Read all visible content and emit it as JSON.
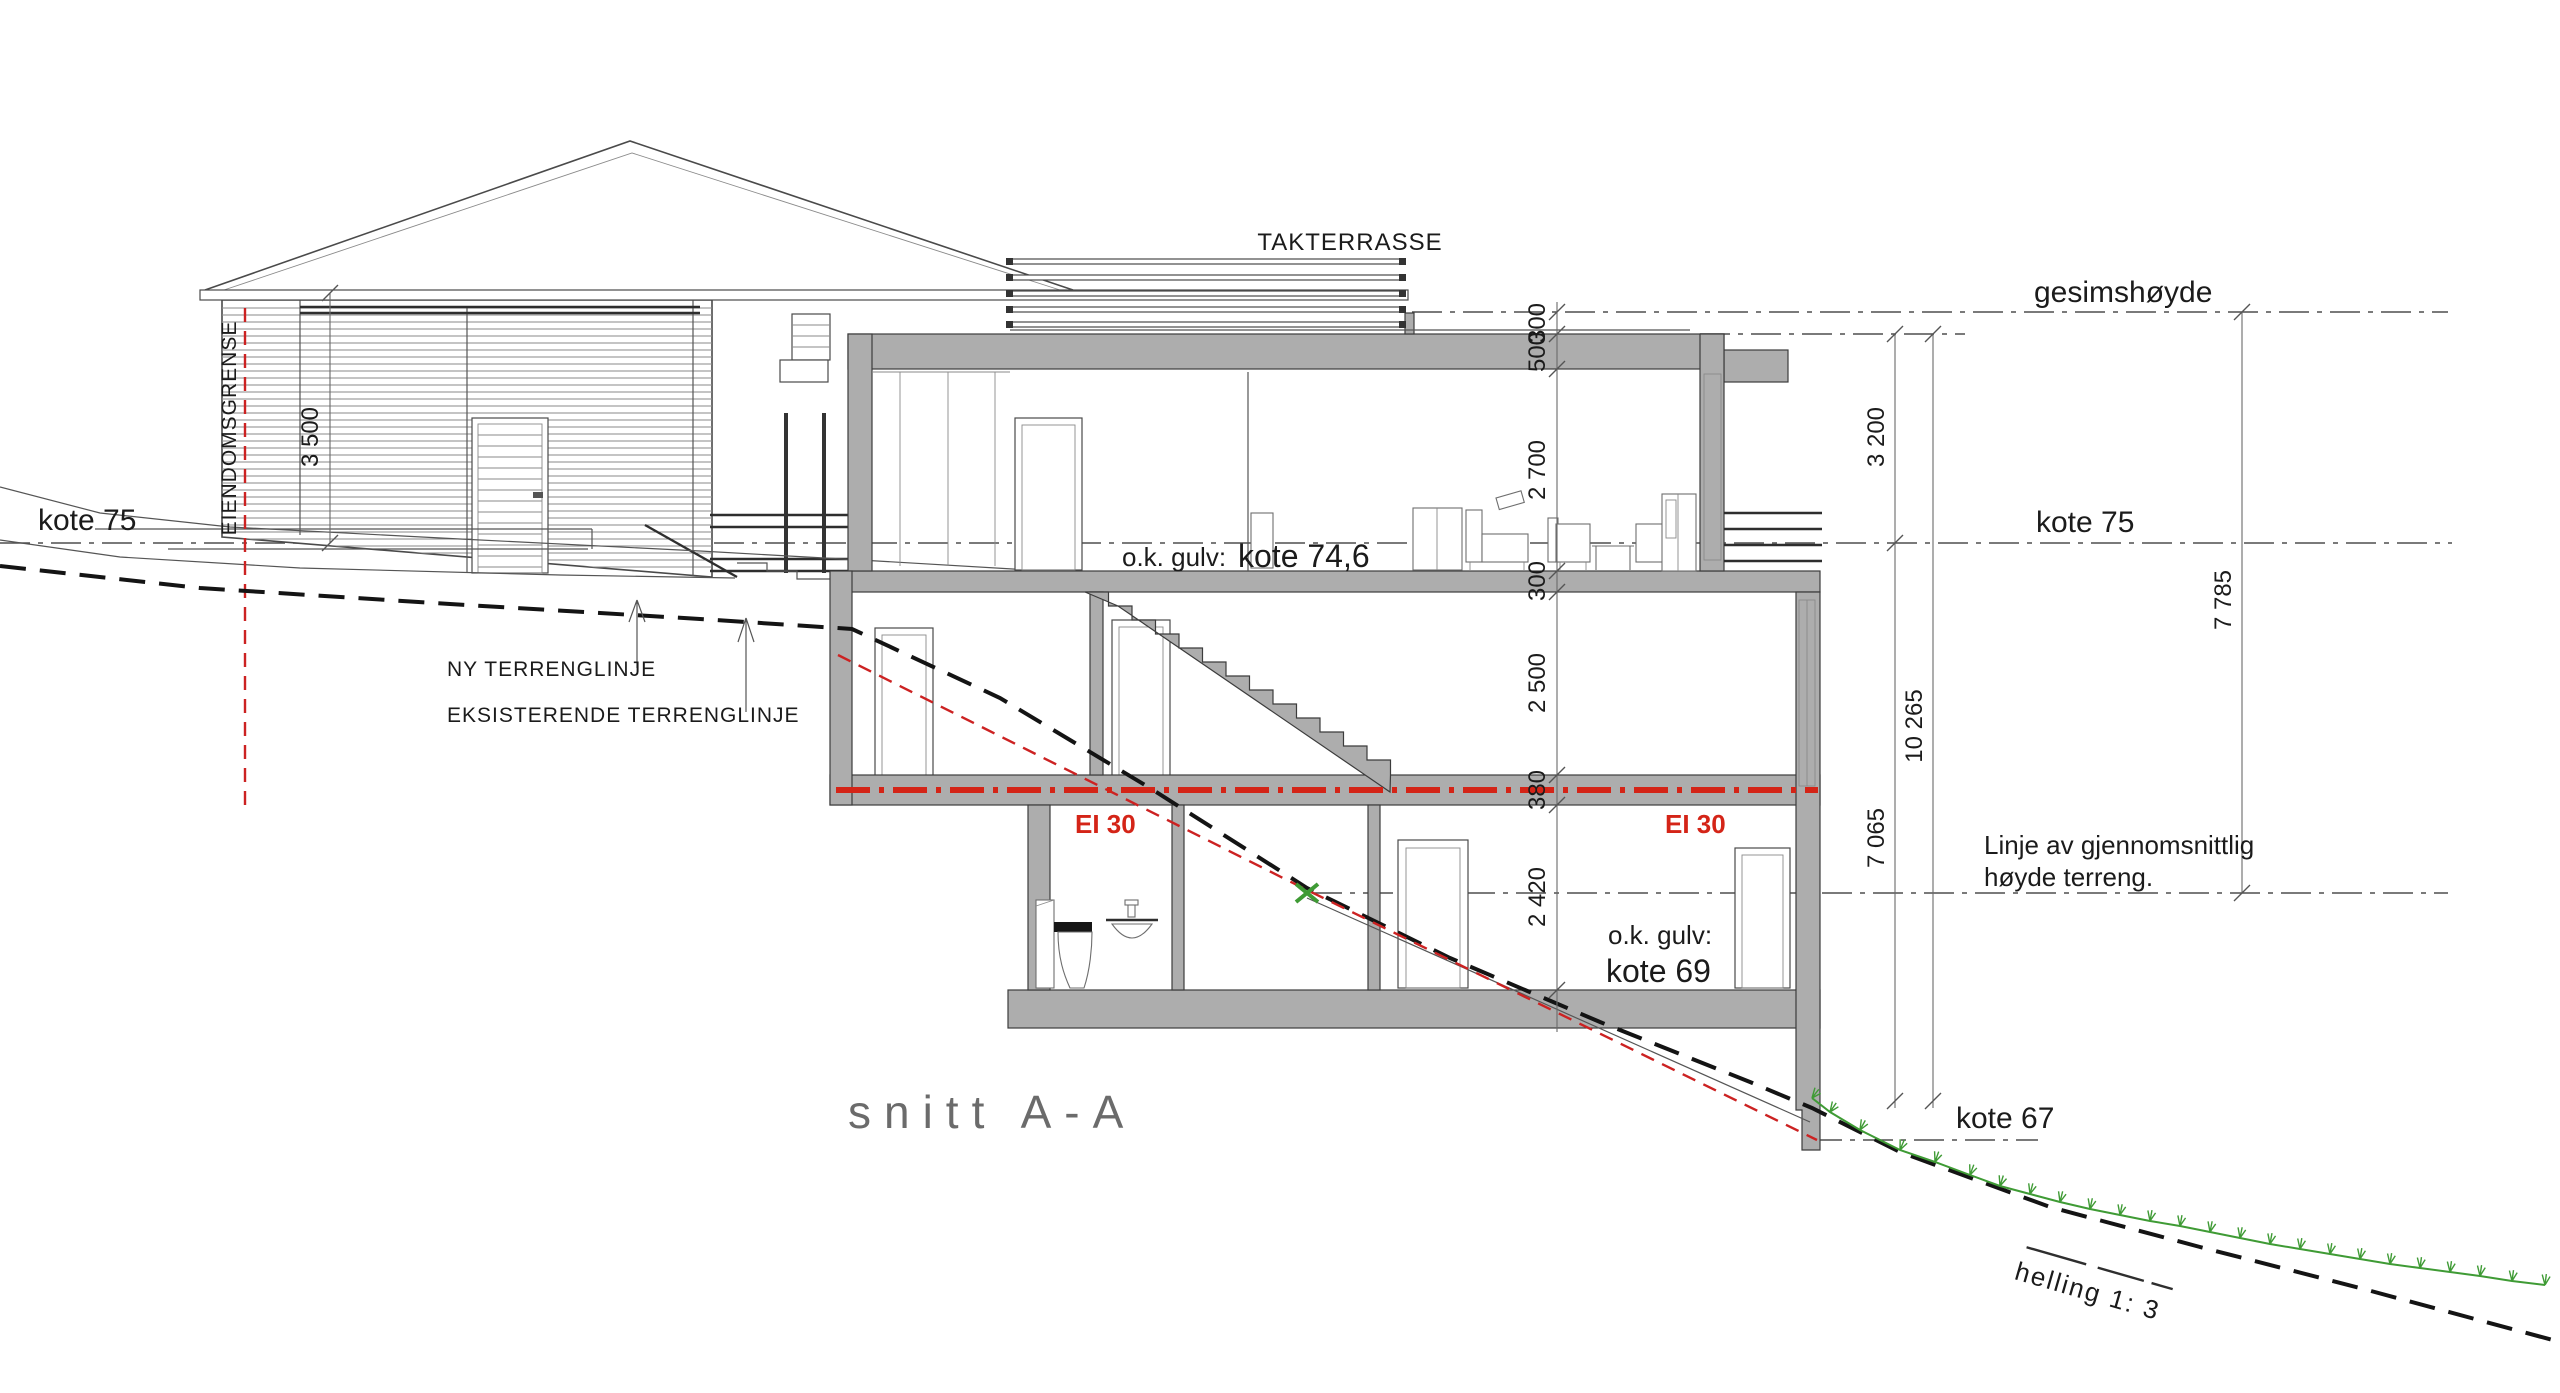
{
  "title": "snitt A-A",
  "labels": {
    "takterrasse": "TAKTERRASSE",
    "gesimshoyde": "gesimshøyde",
    "kote75_left": "kote 75",
    "kote75_right": "kote 75",
    "kote67": "kote 67",
    "ok_gulv_main_prefix": "o.k. gulv:",
    "ok_gulv_main_value": "kote 74,6",
    "ok_gulv_basement_prefix": "o.k. gulv:",
    "ok_gulv_basement_value": "kote 69",
    "eiendomsgrense": "EIENDOMSGRENSE",
    "ny_terrenglinje": "NY  TERRENGLINJE",
    "eksisterende_terrenglinje": "EKSISTERENDE  TERRENGLINJE",
    "linje_gjennomsnittlig_line1": "Linje av gjennomsnittlig",
    "linje_gjennomsnittlig_line2": "høyde terreng.",
    "ei30_left": "EI 30",
    "ei30_right": "EI 30",
    "helling": "helling 1: 3"
  },
  "dimensions": {
    "d3500": "3 500",
    "chain": [
      "300",
      "500",
      "2 700",
      "300",
      "2 500",
      "380",
      "2 420"
    ],
    "d3200": "3 200",
    "d10265": "10 265",
    "d7065": "7 065",
    "d7785": "7 785"
  },
  "colors": {
    "wall": "#adadad",
    "red": "#cc2222",
    "ei30": "#d42417",
    "green": "#3f9b35",
    "title": "#6b6b6b"
  }
}
